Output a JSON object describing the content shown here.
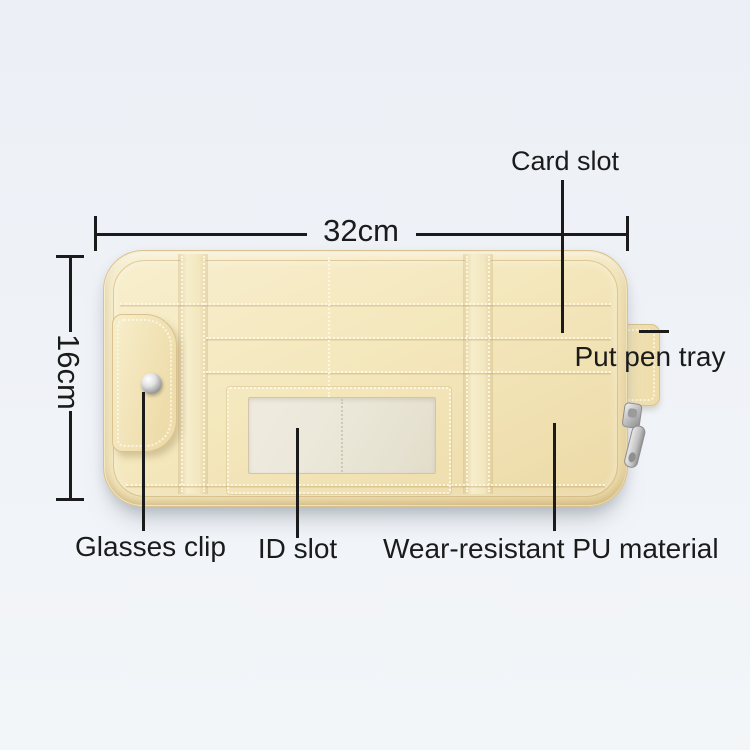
{
  "dimensions": {
    "width": "32cm",
    "height": "16cm"
  },
  "callouts": {
    "card_slot": "Card slot",
    "put_pen_tray": "Put pen tray",
    "glasses_clip": "Glasses clip",
    "id_slot": "ID slot",
    "wear_resistant": "Wear-resistant PU material"
  },
  "colors": {
    "background-top": "#ecf0f6",
    "background-bottom": "#f3f6f9",
    "annotation": "#1b1b1b",
    "leather": "#f4e7bc",
    "leather-dark": "#e9d6a2",
    "leather-edge": "#d9c28f",
    "stitch": "#fdf7e4",
    "id-window": "#eae6d7",
    "metal": "#c9c9c9"
  }
}
